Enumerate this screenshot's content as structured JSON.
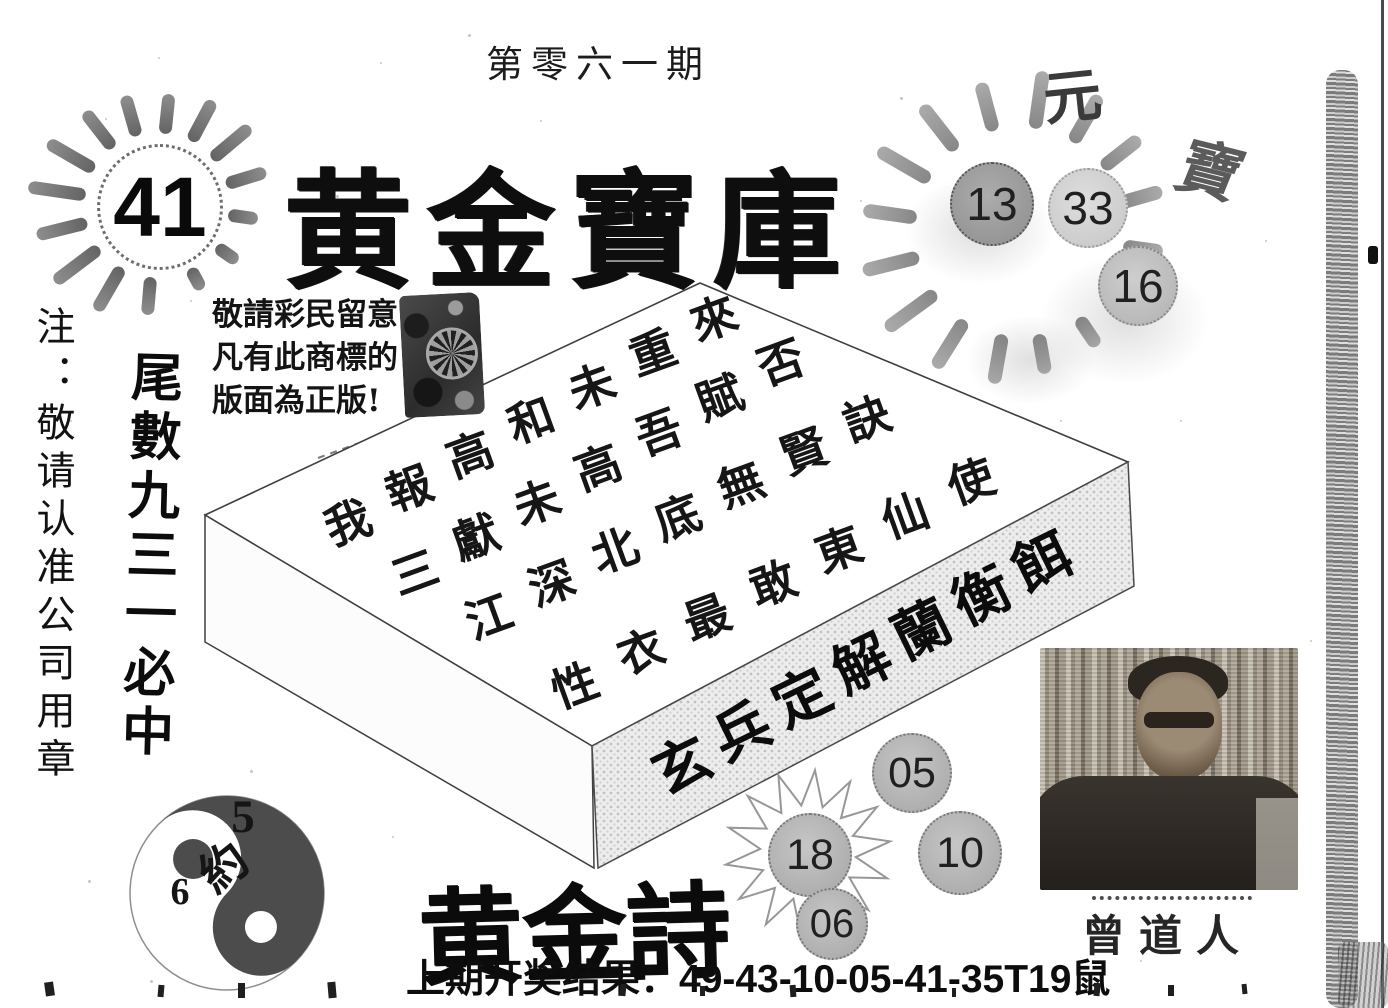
{
  "issue": "第零六一期",
  "title": "黄金寶庫",
  "left_note": "注：敬请认准公司用章",
  "brush_claim": "尾數九三一必中",
  "notice": {
    "lines": [
      "敬請彩民留意",
      "凡有此商標的",
      "版面為正版!"
    ]
  },
  "sun_left_number": "41",
  "sun_right": {
    "calligraphy": [
      "元",
      "寶"
    ],
    "numbers": [
      "13",
      "33",
      "16"
    ]
  },
  "box_poem": {
    "lines": [
      "我報高和未重來",
      "三獻未高吾賦否",
      "江深北底無賢訣",
      "性衣最敢東仙使"
    ],
    "front": "玄兵定解蘭衡餌"
  },
  "taiji": {
    "five": "5",
    "about": "約",
    "six": "6"
  },
  "golden_poem": "黄金詩",
  "balls": {
    "b05": "05",
    "b18": "18",
    "b10": "10",
    "b06": "06"
  },
  "portrait_signature": "曾道人",
  "footer_result": "上期开奖结果：49-43-10-05-41-35T19鼠",
  "colors": {
    "paper": "#ffffff",
    "ink": "#1a1a1a",
    "ball_gray": "#b3b3b3",
    "band_halftone": "#ededed"
  }
}
